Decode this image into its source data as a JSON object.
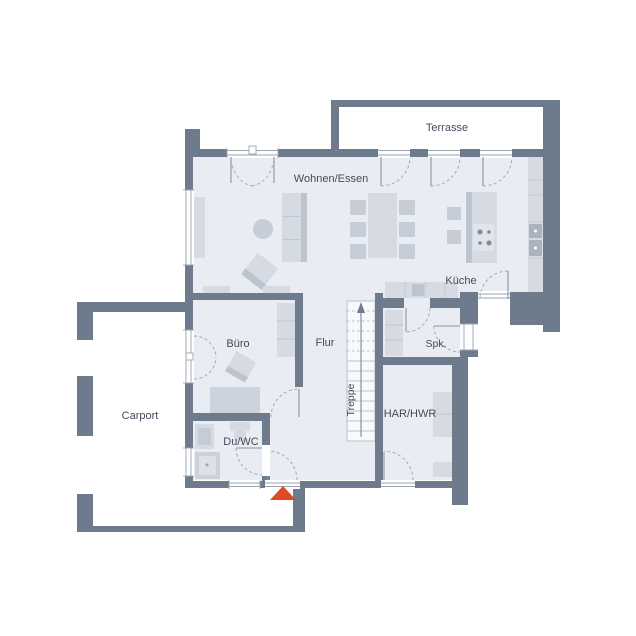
{
  "plan": {
    "type": "floor-plan",
    "rooms": {
      "terrasse": "Terrasse",
      "wohnen_essen": "Wohnen/Essen",
      "kueche": "Küche",
      "buero": "Büro",
      "flur": "Flur",
      "treppe": "Treppe",
      "spk": "Spk.",
      "har_hwr": "HAR/HWR",
      "du_wc": "Du/WC",
      "carport": "Carport"
    },
    "markers": {
      "entrance_arrow": "entrance-direction-marker",
      "stairs_arrow": "stairs-up-direction"
    },
    "colors": {
      "wall": "#6e7b8c",
      "floor": "#e9edf3",
      "furniture_light": "#d5dae3",
      "furniture_mid": "#c6cdd7",
      "furniture_dark": "#aab3c0",
      "entrance_arrow": "#dd4a24",
      "label_text": "#414b5c",
      "background": "#ffffff"
    }
  }
}
